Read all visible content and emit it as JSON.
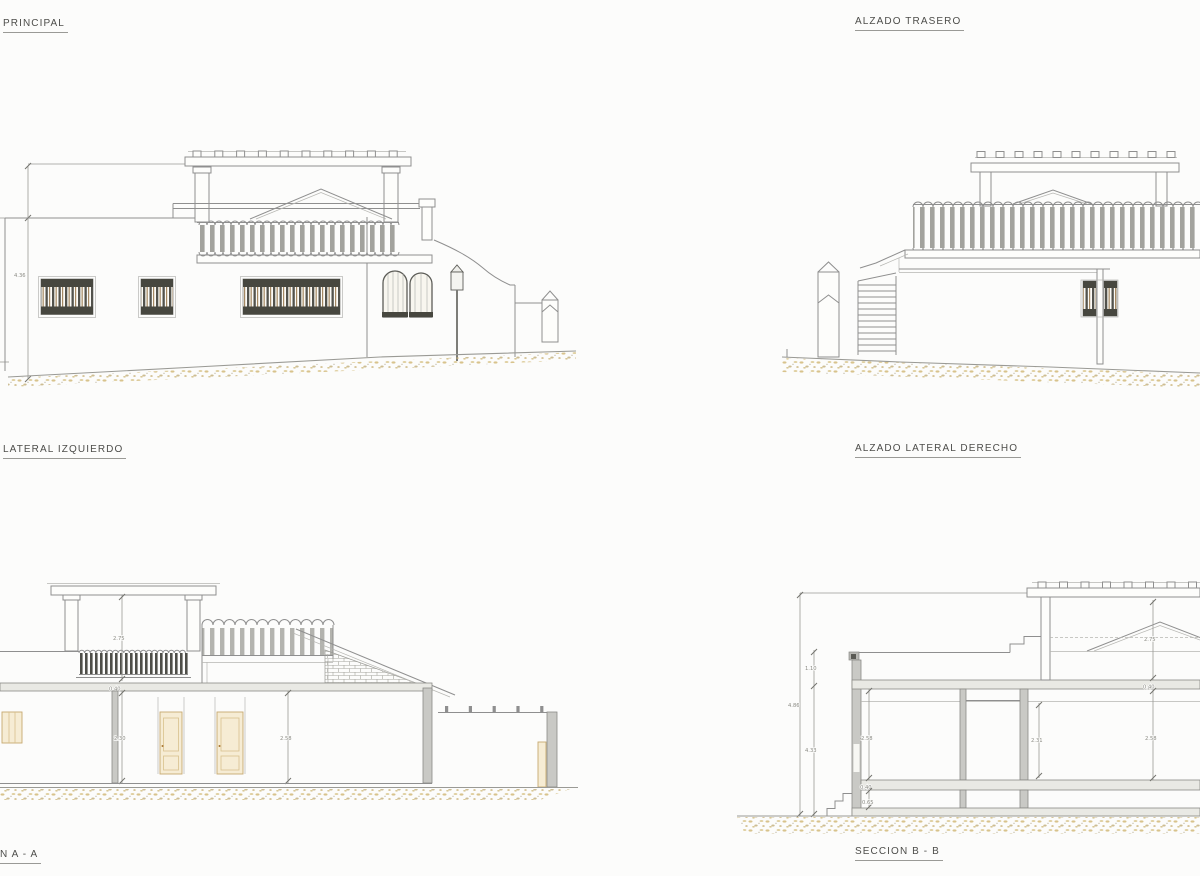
{
  "labels": {
    "principal": "PRINCIPAL",
    "trasero": "ALZADO TRASERO",
    "lateral_izquierdo": "LATERAL IZQUIERDO",
    "lateral_derecho": "ALZADO LATERAL DERECHO",
    "seccion_a": "N A - A",
    "seccion_b": "SECCION B - B"
  },
  "dimensions": {
    "principal": {
      "height_total": "4.36"
    },
    "seccion_a": {
      "pergola_height": "2.75",
      "slab_thickness": "0.40",
      "room_left_height": "2.30",
      "room_right_height": "2.58"
    },
    "seccion_b": {
      "total_height": "4.86",
      "parapet_height": "1.10",
      "wall_height": "4.33",
      "room1_height": "2.58",
      "slab_left": "0.40",
      "crawl_height": "0.65",
      "room2_height": "2.31",
      "room3_height": "2.58",
      "slab_right": "0.40",
      "roof_height": "2.75"
    }
  },
  "colors": {
    "paper": "#fcfcfb",
    "line": "#8f8f8f",
    "wall_fill": "#c9c9c5",
    "wood": "#f6ecd4",
    "ground": "#d8c38c"
  }
}
